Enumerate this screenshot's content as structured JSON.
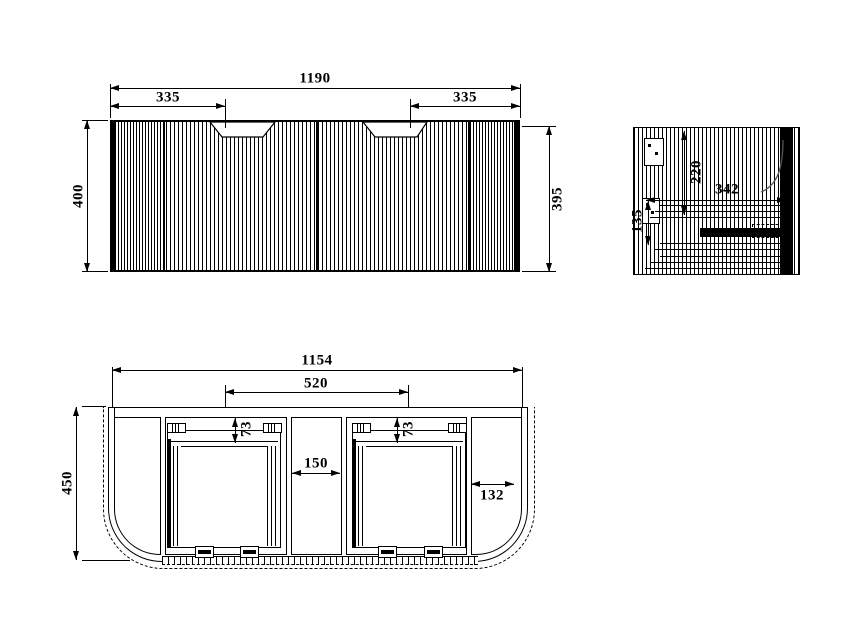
{
  "colors": {
    "line": "#000000",
    "background": "#ffffff"
  },
  "front_view": {
    "overall_width": "1190",
    "left_handle_offset": "335",
    "right_handle_offset": "335",
    "overall_height": "400",
    "panel_height": "395"
  },
  "side_view": {
    "bracket_drop": "220",
    "depth": "342",
    "lower_section": "135"
  },
  "bottom_view": {
    "inner_width": "1154",
    "basin_span": "520",
    "left_drawer_inset": "73",
    "right_drawer_inset": "73",
    "center_gap": "150",
    "side_clearance": "132",
    "overall_depth": "450"
  }
}
